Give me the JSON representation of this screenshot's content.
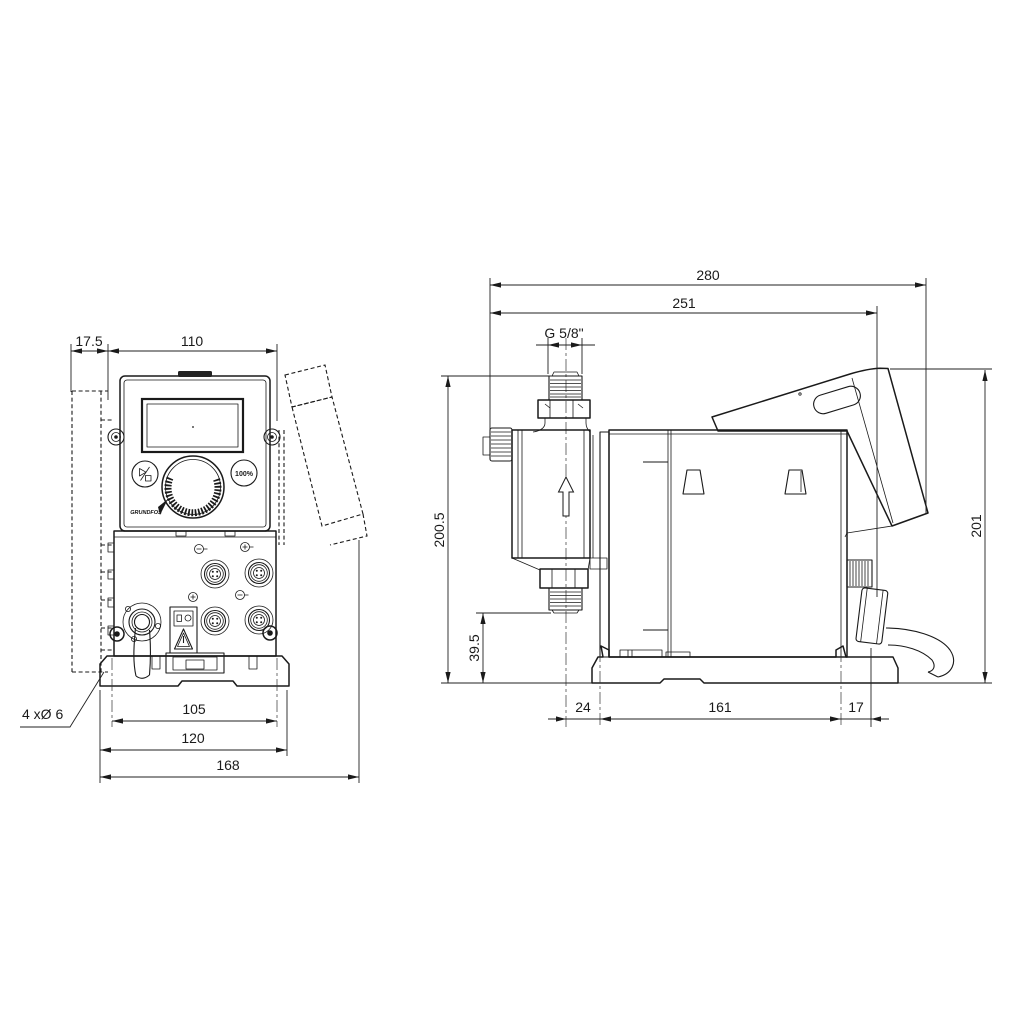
{
  "colors": {
    "background": "#ffffff",
    "line": "#1a1a1a"
  },
  "front_view": {
    "dims": {
      "wall_offset": "17.5",
      "panel_width": "110",
      "hole_spacing": "105",
      "base_width": "120",
      "overall_width": "168"
    },
    "notes": {
      "mounting_holes": "4 xØ 6"
    },
    "controls": {
      "percent_button": "100%",
      "logo": "GRUNDFOS"
    }
  },
  "side_view": {
    "dims": {
      "overall_depth": "280",
      "depth_to_cable_gland": "251",
      "connection_thread": "G 5/8\"",
      "head_height": "200.5",
      "inlet_height": "39.5",
      "overall_height": "201",
      "base_front_offset": "24",
      "base_length": "161",
      "base_rear_offset": "17"
    }
  }
}
